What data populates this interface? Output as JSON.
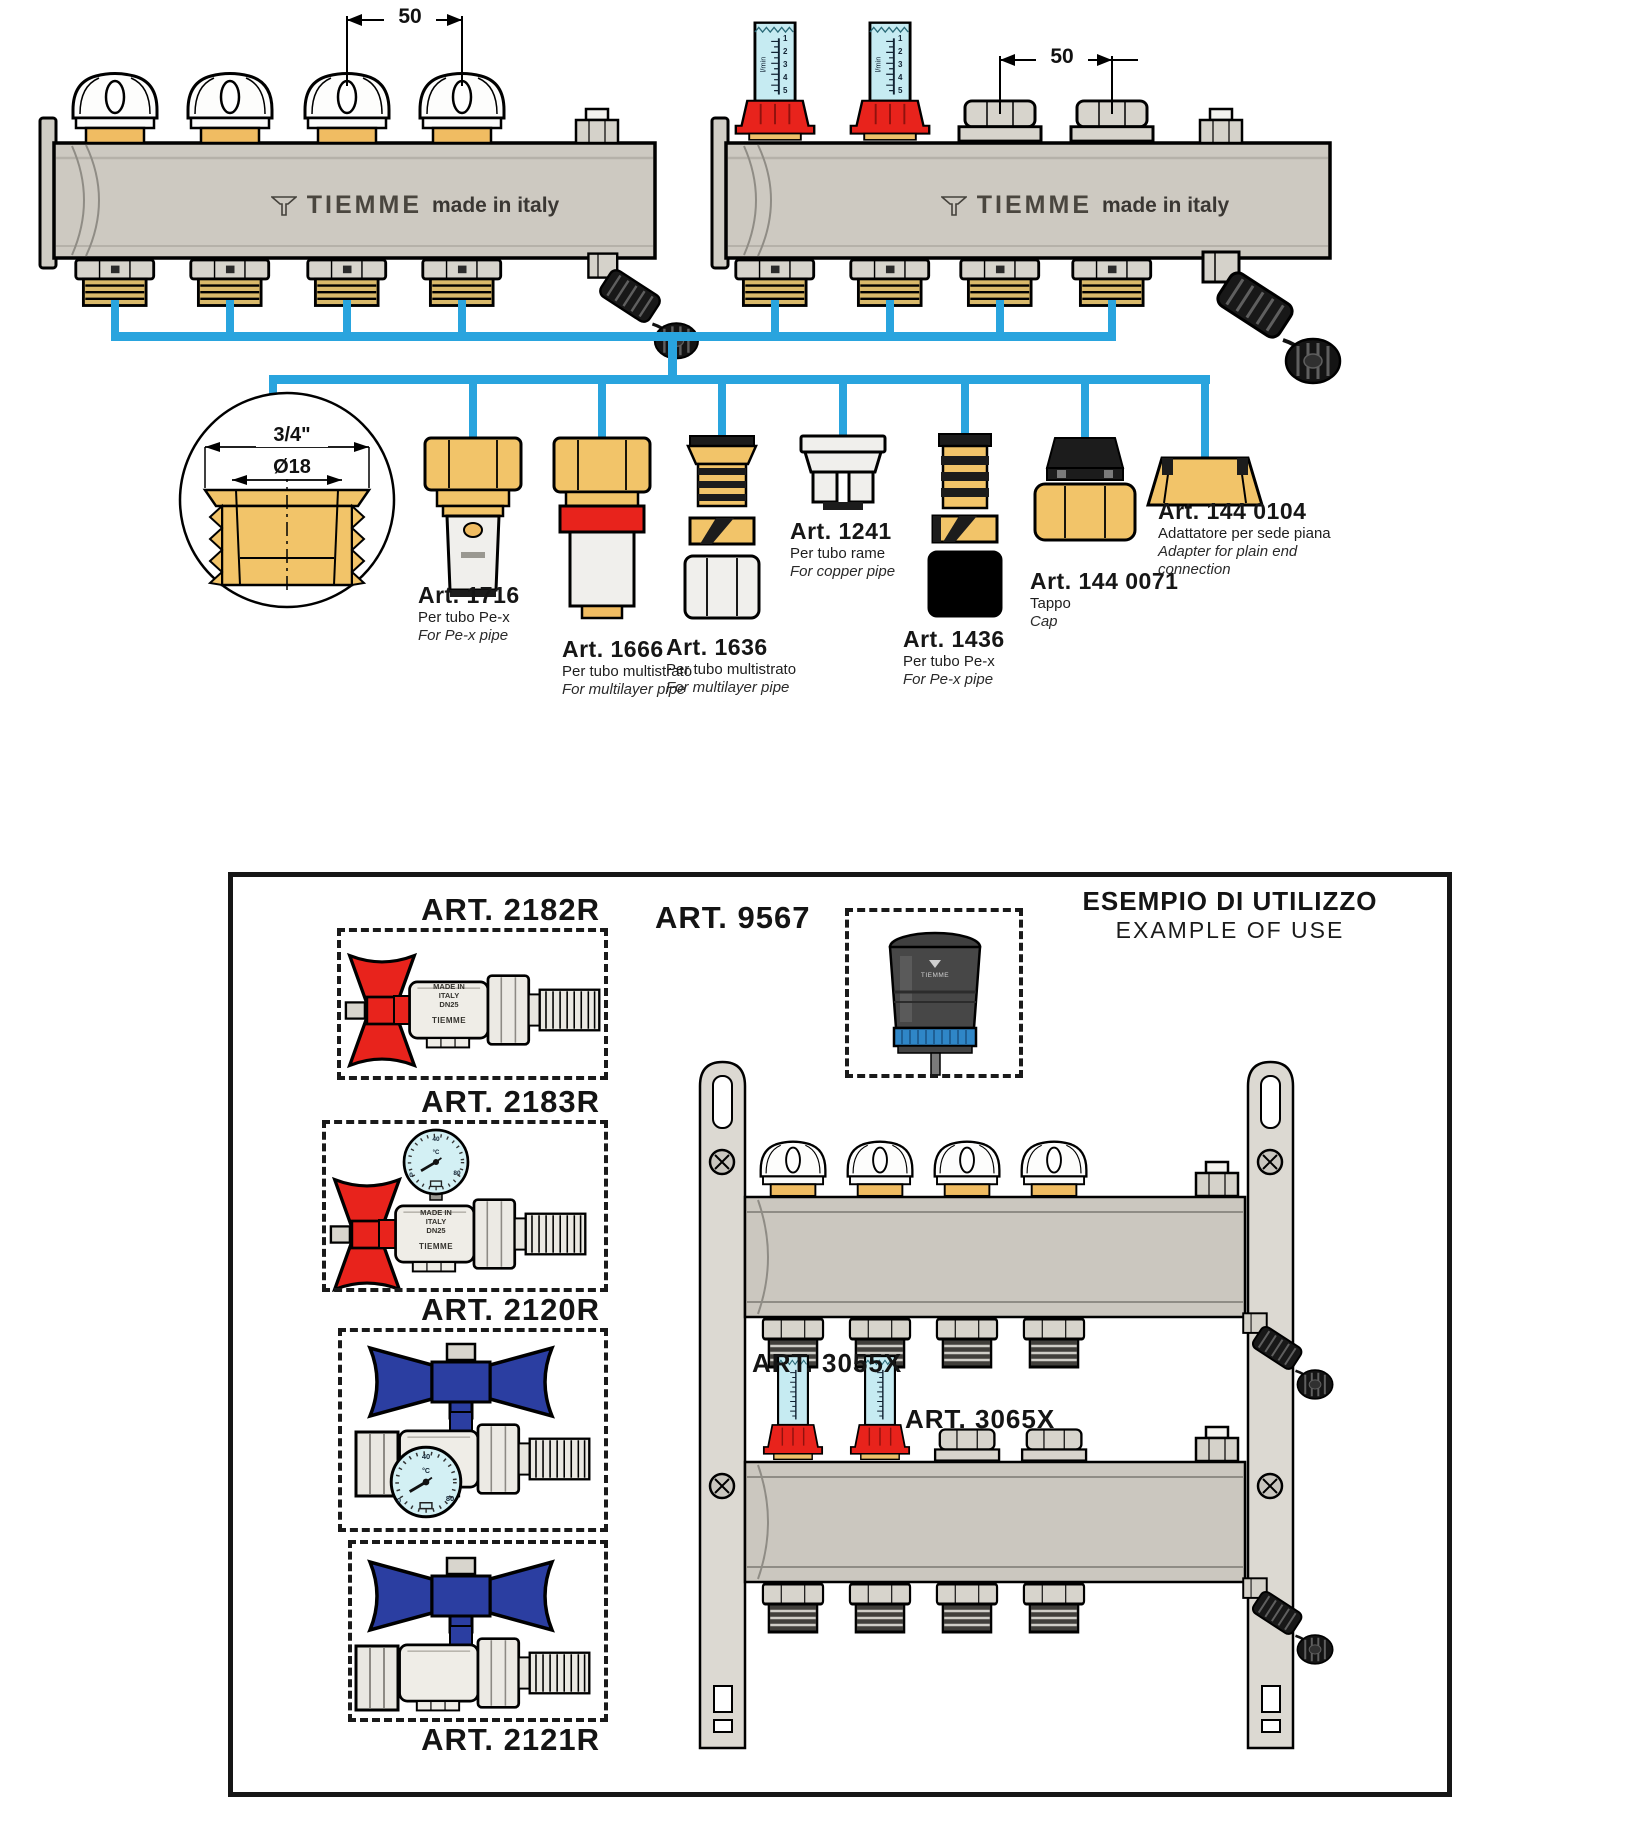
{
  "colors": {
    "pipe_blue": "#29a4de",
    "brass": "#f2c469",
    "red": "#e8231c",
    "flow_glass": "#c6ebf2",
    "handle_blue": "#2b3ea1",
    "dial_face": "#d3f0f4",
    "metal_gray": "#cdc9c1"
  },
  "manifolds": {
    "left": {
      "dim": "50",
      "brand": "TIEMME",
      "origin": "made in italy"
    },
    "right": {
      "dim": "50",
      "brand": "TIEMME",
      "origin": "made in italy"
    }
  },
  "flowmeter": {
    "unit": "l/min",
    "ticks": [
      "1",
      "2",
      "3",
      "4",
      "5"
    ]
  },
  "detail": {
    "outer_dim": "3/4\"",
    "inner_dim": "Ø18"
  },
  "fittings": [
    {
      "art": "Art. 1716",
      "line1": "Per tubo Pe-x",
      "line2": "For Pe-x pipe"
    },
    {
      "art": "Art. 1666",
      "line1": "Per tubo multistrato",
      "line2": "For multilayer pipe"
    },
    {
      "art": "Art. 1636",
      "line1": "Per tubo multistrato",
      "line2": "For multilayer pipe"
    },
    {
      "art": "Art. 1241",
      "line1": "Per tubo rame",
      "line2": "For copper pipe"
    },
    {
      "art": "Art. 1436",
      "line1": "Per tubo Pe-x",
      "line2": "For Pe-x pipe"
    },
    {
      "art": "Art. 144 0071",
      "line1": "Tappo",
      "line2": "Cap"
    },
    {
      "art": "Art. 144 0104",
      "line1": "Adattatore per sede piana",
      "line2": "Adapter for plain end connection"
    }
  ],
  "example": {
    "title_it": "ESEMPIO DI UTILIZZO",
    "title_en": "EXAMPLE OF USE",
    "labels": {
      "v2182": "ART. 2182R",
      "v2183": "ART. 2183R",
      "v2120": "ART. 2120R",
      "v2121": "ART. 2121R",
      "act": "ART. 9567",
      "m3055": "ART. 3055X",
      "m3065": "ART. 3065X"
    },
    "valve_marking": {
      "l1": "MADE IN",
      "l2": "ITALY",
      "l3": "DN25",
      "brand": "TIEMME"
    },
    "actuator_brand": "TIEMME",
    "dial": {
      "top": "40",
      "low_left": "0",
      "low_right": "80",
      "unit": "°C"
    }
  }
}
